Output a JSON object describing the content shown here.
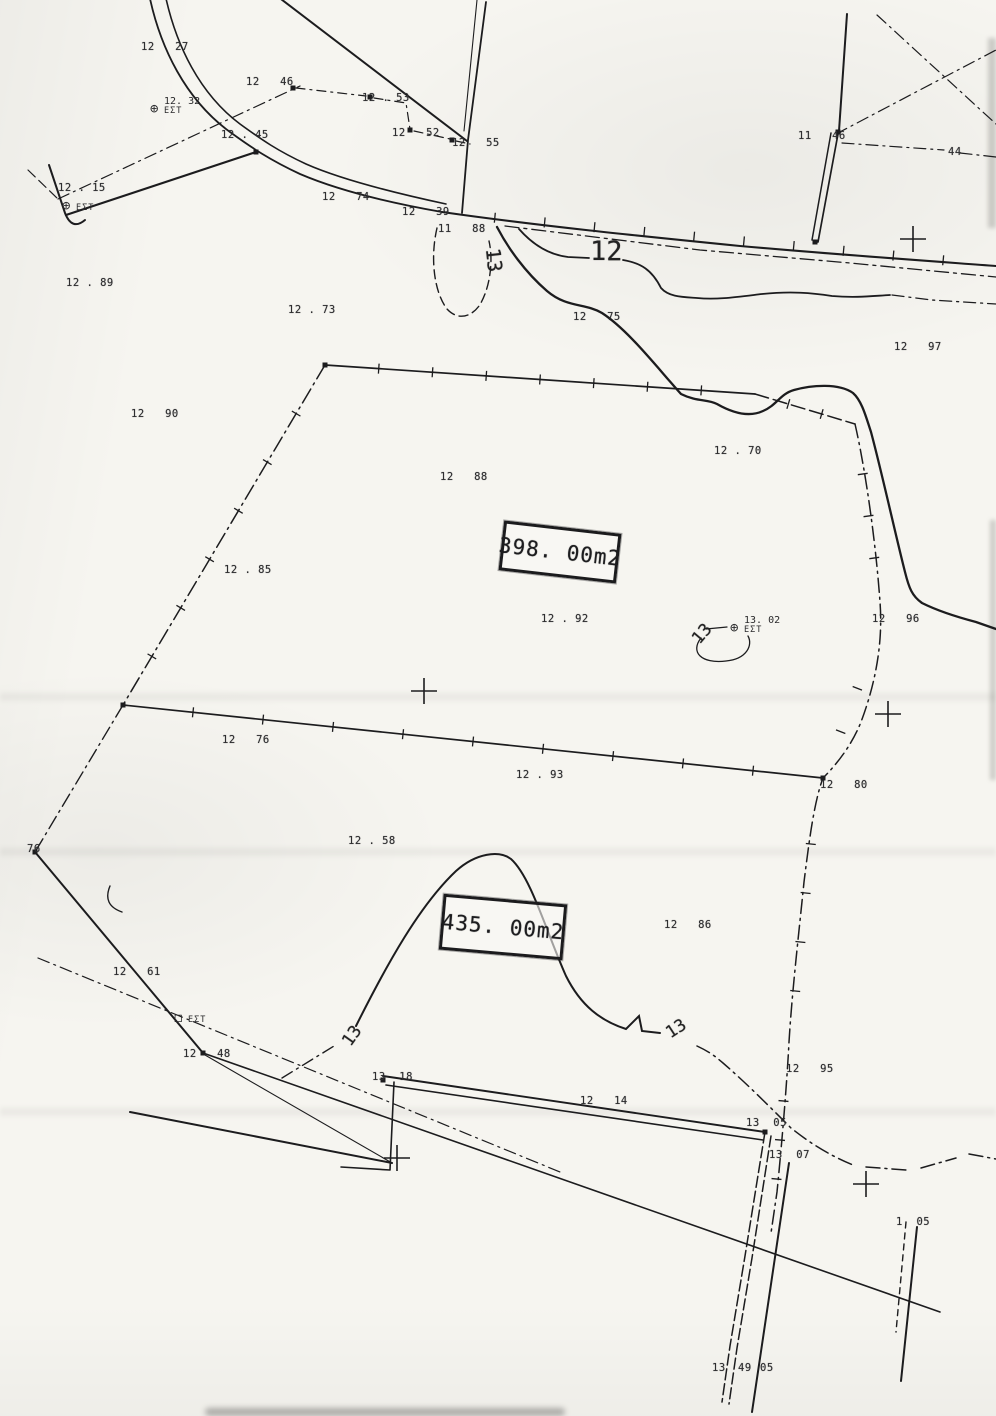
{
  "map": {
    "paper_color": "#f6f5f0",
    "ink_color": "#1c1c1e",
    "parcels": [
      {
        "area_label": "398. 00m2"
      },
      {
        "area_label": "435. 00m2"
      }
    ],
    "contour_labels": [
      {
        "text": "12",
        "x": 590,
        "y": 236,
        "size": 27,
        "rot": 0
      },
      {
        "text": "13",
        "x": 482,
        "y": 248,
        "size": 20,
        "rot": 84
      },
      {
        "text": "13",
        "x": 692,
        "y": 624,
        "size": 17,
        "rot": -50
      },
      {
        "text": "13",
        "x": 342,
        "y": 1026,
        "size": 17,
        "rot": -55
      },
      {
        "text": "13",
        "x": 666,
        "y": 1019,
        "size": 17,
        "rot": -33
      }
    ],
    "spot_elevations": [
      {
        "text": "12   27",
        "x": 141,
        "y": 41
      },
      {
        "text": "12   46",
        "x": 246,
        "y": 76
      },
      {
        "text": "12 . 53",
        "x": 362,
        "y": 92
      },
      {
        "text": "12   52",
        "x": 392,
        "y": 127
      },
      {
        "text": "12   55",
        "x": 452,
        "y": 137
      },
      {
        "text": "11   46",
        "x": 798,
        "y": 130
      },
      {
        "text": "44",
        "x": 948,
        "y": 146
      },
      {
        "text": "12 . 45",
        "x": 221,
        "y": 129
      },
      {
        "text": "12 . 15",
        "x": 58,
        "y": 182
      },
      {
        "text": "12   74",
        "x": 322,
        "y": 191
      },
      {
        "text": "12   39",
        "x": 402,
        "y": 206
      },
      {
        "text": "11   88",
        "x": 438,
        "y": 223
      },
      {
        "text": "12 . 89",
        "x": 66,
        "y": 277
      },
      {
        "text": "12 . 73",
        "x": 288,
        "y": 304
      },
      {
        "text": "12   75",
        "x": 573,
        "y": 311
      },
      {
        "text": "12   97",
        "x": 894,
        "y": 341
      },
      {
        "text": "12   90",
        "x": 131,
        "y": 408
      },
      {
        "text": "12 . 70",
        "x": 714,
        "y": 445
      },
      {
        "text": "12   88",
        "x": 440,
        "y": 471
      },
      {
        "text": "12 . 85",
        "x": 224,
        "y": 564
      },
      {
        "text": "12 . 92",
        "x": 541,
        "y": 613
      },
      {
        "text": "12   96",
        "x": 872,
        "y": 613
      },
      {
        "text": "12   76",
        "x": 222,
        "y": 734
      },
      {
        "text": "12 . 93",
        "x": 516,
        "y": 769
      },
      {
        "text": "12   80",
        "x": 820,
        "y": 779
      },
      {
        "text": "12 . 58",
        "x": 348,
        "y": 835
      },
      {
        "text": "12   86",
        "x": 664,
        "y": 919
      },
      {
        "text": "76",
        "x": 27,
        "y": 843
      },
      {
        "text": "12   61",
        "x": 113,
        "y": 966
      },
      {
        "text": "12   48",
        "x": 183,
        "y": 1048
      },
      {
        "text": "13  18",
        "x": 372,
        "y": 1071
      },
      {
        "text": "12   14",
        "x": 580,
        "y": 1095
      },
      {
        "text": "13  05",
        "x": 746,
        "y": 1117
      },
      {
        "text": "12   95",
        "x": 786,
        "y": 1063
      },
      {
        "text": "13  07",
        "x": 769,
        "y": 1149
      },
      {
        "text": "1  05",
        "x": 896,
        "y": 1216
      },
      {
        "text": "13",
        "x": 712,
        "y": 1362
      },
      {
        "text": "49",
        "x": 738,
        "y": 1362
      },
      {
        "text": "05",
        "x": 760,
        "y": 1362
      }
    ],
    "benchmarks": [
      {
        "sym": "⊕",
        "label": "12. 32",
        "sub": "ΕΣΤ",
        "x": 150,
        "y": 102
      },
      {
        "sym": "⊕",
        "label": "",
        "sub": "ΕΣΤ",
        "x": 62,
        "y": 199
      },
      {
        "sym": "⊕",
        "label": "13. 02",
        "sub": "ΕΣΤ",
        "x": 730,
        "y": 621
      },
      {
        "sym": "◻",
        "label": "",
        "sub": "ΕΣΤ",
        "x": 174,
        "y": 1011
      }
    ],
    "crosses": [
      {
        "x": 913,
        "y": 239
      },
      {
        "x": 424,
        "y": 691
      },
      {
        "x": 888,
        "y": 714
      },
      {
        "x": 397,
        "y": 1158
      },
      {
        "x": 866,
        "y": 1184
      }
    ],
    "ticks": [
      {
        "x1": 325,
        "y1": 365,
        "x2": 755,
        "y2": 394,
        "n": 7
      },
      {
        "x1": 755,
        "y1": 394,
        "x2": 855,
        "y2": 424,
        "n": 2
      },
      {
        "x1": 325,
        "y1": 365,
        "x2": 123,
        "y2": 705,
        "n": 6
      },
      {
        "x1": 123,
        "y1": 705,
        "x2": 823,
        "y2": 778,
        "n": 9
      },
      {
        "x1": 857,
        "y1": 432,
        "x2": 880,
        "y2": 600,
        "n": 3
      },
      {
        "x1": 874,
        "y1": 645,
        "x2": 824,
        "y2": 775,
        "n": 2
      },
      {
        "x1": 816,
        "y1": 795,
        "x2": 790,
        "y2": 1040,
        "n": 4
      },
      {
        "x1": 787,
        "y1": 1062,
        "x2": 773,
        "y2": 1218,
        "n": 3
      },
      {
        "x1": 445,
        "y1": 213,
        "x2": 993,
        "y2": 265,
        "n": 10
      }
    ],
    "markers": [
      [
        293,
        88
      ],
      [
        370,
        97
      ],
      [
        410,
        130
      ],
      [
        452,
        140
      ],
      [
        838,
        132
      ],
      [
        815,
        242
      ],
      [
        383,
        1080
      ],
      [
        765,
        1132
      ],
      [
        203,
        1053
      ],
      [
        123,
        705
      ],
      [
        325,
        365
      ],
      [
        823,
        778
      ],
      [
        35,
        852
      ],
      [
        256,
        152
      ]
    ]
  }
}
